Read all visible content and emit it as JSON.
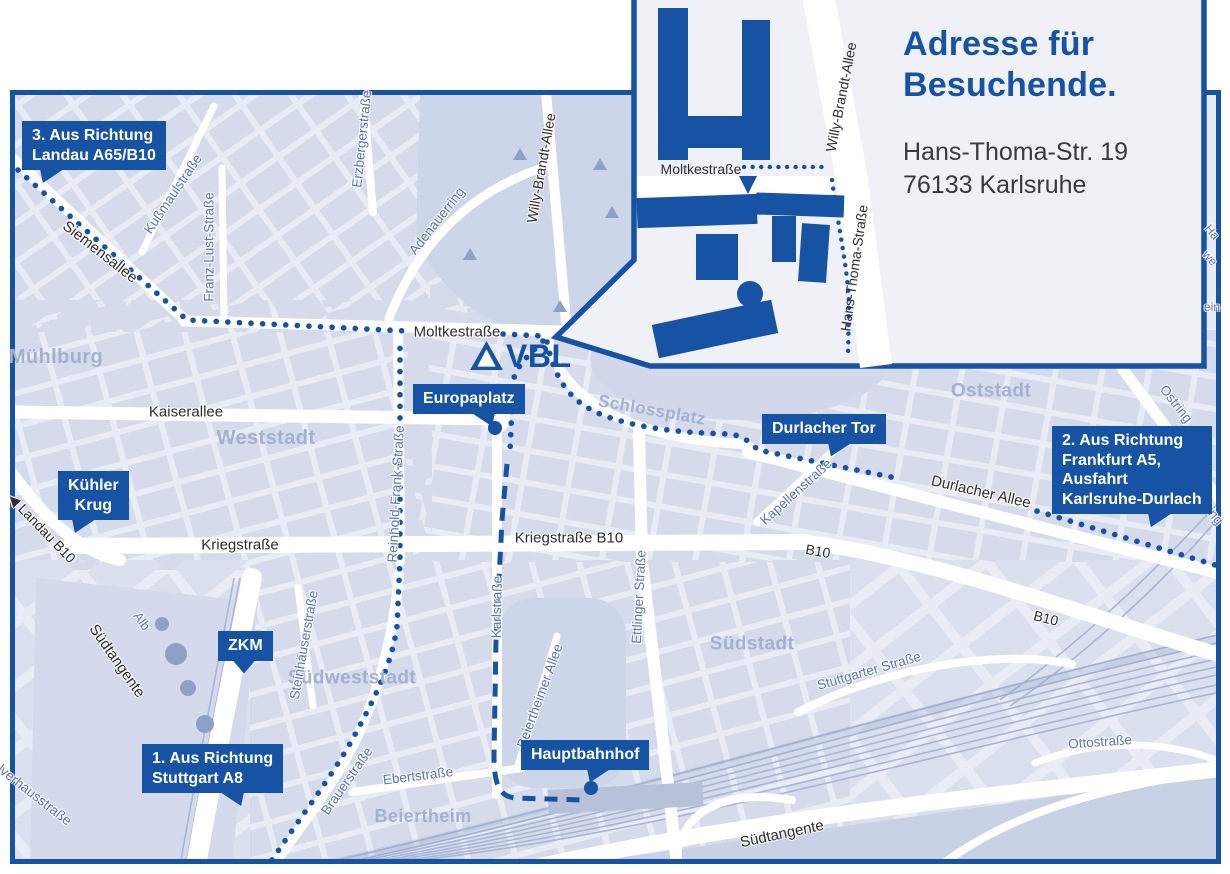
{
  "colors": {
    "brand_blue": "#1753a5",
    "map_background": "#e9ecf5",
    "city_block": "#d5dbeb",
    "park": "#cdd5e8",
    "district_label": "#a4b0d2",
    "street_label_dark": "#2d2d2d",
    "street_label_blue": "#5b74b4",
    "route_color": "#1753a5"
  },
  "logo": {
    "text": "VBL"
  },
  "inset": {
    "title": [
      "Adresse für",
      "Besuchende."
    ],
    "address": [
      "Hans-Thoma-Str. 19",
      "76133 Karlsruhe"
    ],
    "labels": [
      {
        "t": "Moltkestraße",
        "x": 701,
        "y": 169,
        "r": 0,
        "c": "ik",
        "s": 14
      },
      {
        "t": "Willy-Brandt-Allee",
        "x": 841,
        "y": 97,
        "r": -79,
        "c": "ik",
        "s": 14
      },
      {
        "t": "Hans-Thoma-Straße",
        "x": 854,
        "y": 268,
        "r": -82,
        "c": "ik",
        "s": 14
      }
    ]
  },
  "map": {
    "labels": [
      {
        "t": "Mühlburg",
        "x": 56,
        "y": 357,
        "r": 0,
        "c": "d",
        "s": 20
      },
      {
        "t": "Weststadt",
        "x": 266,
        "y": 438,
        "r": 0,
        "c": "d",
        "s": 20
      },
      {
        "t": "Südweststadt",
        "x": 352,
        "y": 678,
        "r": 0,
        "c": "d",
        "s": 19
      },
      {
        "t": "Beiertheim",
        "x": 423,
        "y": 816,
        "r": 0,
        "c": "d",
        "s": 18
      },
      {
        "t": "Südstadt",
        "x": 752,
        "y": 644,
        "r": 0,
        "c": "d",
        "s": 19
      },
      {
        "t": "Oststadt",
        "x": 991,
        "y": 391,
        "r": 0,
        "c": "d",
        "s": 19
      },
      {
        "t": "Schlossplatz",
        "x": 652,
        "y": 410,
        "r": 10,
        "c": "d",
        "s": 17
      },
      {
        "t": "Siemensallee",
        "x": 100,
        "y": 252,
        "r": 38,
        "c": "k",
        "s": 15
      },
      {
        "t": "Kaiserallee",
        "x": 186,
        "y": 412,
        "r": 0,
        "c": "k",
        "s": 15
      },
      {
        "t": "Kriegstraße",
        "x": 240,
        "y": 545,
        "r": 0,
        "c": "k",
        "s": 15
      },
      {
        "t": "Kriegstraße B10",
        "x": 569,
        "y": 538,
        "r": 0,
        "c": "k",
        "s": 15
      },
      {
        "t": "Moltkestraße",
        "x": 457,
        "y": 332,
        "r": 0,
        "c": "k",
        "s": 15
      },
      {
        "t": "Willy-Brandt-Allee",
        "x": 541,
        "y": 168,
        "r": -80,
        "c": "k",
        "s": 14
      },
      {
        "t": "Durlacher Allee",
        "x": 981,
        "y": 492,
        "r": 13,
        "c": "k",
        "s": 15
      },
      {
        "t": "B10",
        "x": 818,
        "y": 551,
        "r": 10,
        "c": "k",
        "s": 14
      },
      {
        "t": "B10",
        "x": 1046,
        "y": 618,
        "r": 14,
        "c": "k",
        "s": 14
      },
      {
        "t": "Südtangente",
        "x": 782,
        "y": 834,
        "r": -12,
        "c": "k",
        "s": 15
      },
      {
        "t": "Südtangente",
        "x": 117,
        "y": 661,
        "r": 55,
        "c": "k",
        "s": 15
      },
      {
        "t": "◀ Landau B10",
        "x": 42,
        "y": 528,
        "r": 46,
        "c": "k",
        "s": 14
      },
      {
        "t": "Kußmaulstraße",
        "x": 173,
        "y": 194,
        "r": -56,
        "c": "b",
        "s": 13.5
      },
      {
        "t": "Franz-Lust-Straße",
        "x": 209,
        "y": 247,
        "r": -90,
        "c": "b",
        "s": 13.5
      },
      {
        "t": "Erzbergerstraße",
        "x": 362,
        "y": 139,
        "r": -84,
        "c": "b",
        "s": 13.5
      },
      {
        "t": "Adenauerring",
        "x": 437,
        "y": 221,
        "r": -52,
        "c": "b",
        "s": 13.5
      },
      {
        "t": "Reinhold-Frank-Straße",
        "x": 396,
        "y": 494,
        "r": -87,
        "c": "b",
        "s": 13.5
      },
      {
        "t": "Karlstraße",
        "x": 497,
        "y": 607,
        "r": -89,
        "c": "b",
        "s": 13.5
      },
      {
        "t": "Ettlinger Straße",
        "x": 639,
        "y": 597,
        "r": -87,
        "c": "b",
        "s": 13.5
      },
      {
        "t": "Steinhäuserstraße",
        "x": 304,
        "y": 645,
        "r": -80,
        "c": "b",
        "s": 13.5
      },
      {
        "t": "Brauerstraße",
        "x": 347,
        "y": 781,
        "r": -55,
        "c": "b",
        "s": 13.5
      },
      {
        "t": "Ebertstraße",
        "x": 418,
        "y": 776,
        "r": -7,
        "c": "b",
        "s": 13.5
      },
      {
        "t": "Beiertheimer Allee",
        "x": 540,
        "y": 696,
        "r": -70,
        "c": "b",
        "s": 13.5
      },
      {
        "t": "Stuttgarter Straße",
        "x": 869,
        "y": 671,
        "r": -16,
        "c": "b",
        "s": 13.5
      },
      {
        "t": "Kapellenstraße",
        "x": 796,
        "y": 492,
        "r": -42,
        "c": "b",
        "s": 13.5
      },
      {
        "t": "Ostring",
        "x": 1176,
        "y": 404,
        "r": 52,
        "c": "b",
        "s": 13.5
      },
      {
        "t": "Ostring",
        "x": 1207,
        "y": 506,
        "r": 52,
        "c": "b",
        "s": 13.5
      },
      {
        "t": "Ottostraße",
        "x": 1100,
        "y": 742,
        "r": -4,
        "c": "b",
        "s": 13.5
      },
      {
        "t": "Pulverhausstraße",
        "x": 28,
        "y": 790,
        "r": 38,
        "c": "b",
        "s": 13.5
      },
      {
        "t": "Alb",
        "x": 142,
        "y": 621,
        "r": 55,
        "c": "b",
        "s": 13
      },
      {
        "t": "Ha",
        "x": 1212,
        "y": 232,
        "r": 50,
        "c": "b",
        "s": 12
      },
      {
        "t": "we",
        "x": 1210,
        "y": 258,
        "r": 50,
        "c": "b",
        "s": 12
      },
      {
        "t": "ein",
        "x": 1212,
        "y": 307,
        "r": 0,
        "c": "b",
        "s": 12
      }
    ],
    "callouts": [
      {
        "id": "callout-landau",
        "x": 22,
        "y": 121,
        "lines": [
          "3. Aus Richtung",
          "Landau A65/B10"
        ],
        "ptr": "left",
        "px": 18
      },
      {
        "id": "callout-kuehler-krug",
        "x": 58,
        "y": 471,
        "lines": [
          "Kühler",
          "Krug"
        ],
        "ptr": "left",
        "px": 14,
        "center": true
      },
      {
        "id": "callout-zkm",
        "x": 218,
        "y": 631,
        "lines": [
          "ZKM"
        ],
        "ptr": "center",
        "px": 14
      },
      {
        "id": "callout-stuttgart",
        "x": 142,
        "y": 744,
        "lines": [
          "1. Aus Richtung",
          "Stuttgart A8"
        ],
        "ptr": "right",
        "px": 78
      },
      {
        "id": "callout-europaplatz",
        "x": 413,
        "y": 384,
        "lines": [
          "Europaplatz"
        ],
        "ptr": "right",
        "px": 58,
        "dot": [
          495,
          428
        ]
      },
      {
        "id": "callout-durlacher-tor",
        "x": 762,
        "y": 414,
        "lines": [
          "Durlacher Tor"
        ],
        "ptr": "left",
        "px": 66
      },
      {
        "id": "callout-frankfurt",
        "x": 1052,
        "y": 426,
        "lines": [
          "2. Aus Richtung",
          "Frankfurt A5,",
          "Ausfahrt",
          "Karlsruhe-Durlach"
        ],
        "ptr": "left",
        "px": 96
      },
      {
        "id": "callout-hauptbahnhof",
        "x": 521,
        "y": 740,
        "lines": [
          "Hauptbahnhof"
        ],
        "ptr": "left",
        "px": 66,
        "dot": [
          591,
          788
        ]
      }
    ],
    "routes": [
      {
        "n": "route-3-siemensallee",
        "s": "dots",
        "d": "M 18 170 L 187 320 L 406 331"
      },
      {
        "n": "route-3-moltkestrasse-east",
        "s": "dots",
        "d": "M 503 334 L 543 336"
      },
      {
        "n": "route-1-stuttgart",
        "s": "dots",
        "d": "M 272 860 C 300 818 332 776 352 740 C 374 700 392 664 397 626 L 400 560 L 400 344"
      },
      {
        "n": "route-2-schlossplatz-arc",
        "s": "dots",
        "d": "M 547 342 C 555 382 572 402 600 414 C 640 430 690 433 730 434 C 744 436 752 444 758 450 L 896 478"
      },
      {
        "n": "route-2-durlacher-allee",
        "s": "dots",
        "d": "M 1037 511 L 1225 568"
      },
      {
        "n": "route-vbl-europaplatz",
        "s": "dots",
        "d": "M 543 341 C 527 357 516 366 513 382 L 510 452"
      },
      {
        "n": "route-hauptbahnhof-dashed",
        "s": "dash",
        "d": "M 507 464 L 502 520 L 496 640 L 494 756 C 494 783 499 797 516 798 L 584 800"
      },
      {
        "n": "route-inset-moltkestrasse",
        "s": "dotsS",
        "d": "M 744 167 L 828 167"
      },
      {
        "n": "route-inset-hans-thoma",
        "s": "dotsS",
        "d": "M 832 180 C 839 232 847 264 849 302 L 848 358"
      }
    ]
  }
}
